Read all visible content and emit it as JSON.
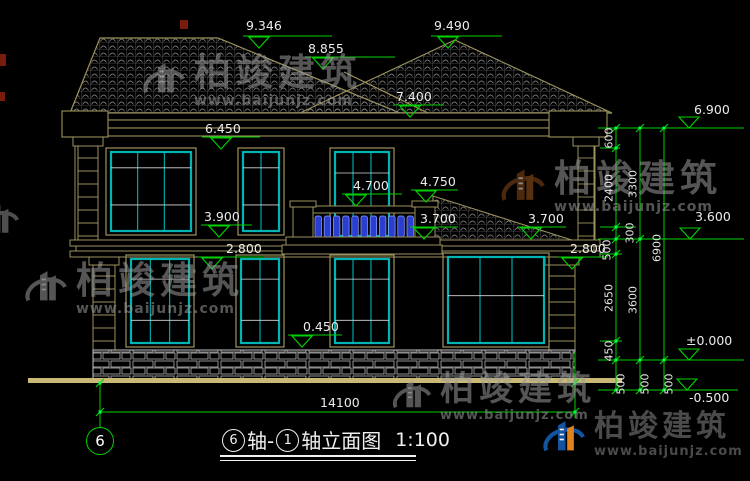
{
  "watermark": {
    "brand": "柏竣建筑",
    "url": "www.baijunjz.com"
  },
  "markers": {
    "ridge_left": "9.346",
    "valley": "8.855",
    "ridge_right": "9.490",
    "roof_low": "7.400",
    "f2_window_top": "6.450",
    "f2_band": "3.900",
    "balcony_rail": "4.700",
    "porch_top": "4.750",
    "balcony_floor": "3.700",
    "porch_eave": "3.700",
    "f1_band_right": "2.800",
    "f1_window_top": "2.800",
    "f1_sill": "0.450",
    "eave_right": "6.900",
    "f2_floor_right": "3.600",
    "ground": "±0.000",
    "site": "-0.500"
  },
  "dims": {
    "chain_inner": [
      "600",
      "2400",
      "300",
      "500",
      "2650",
      "450",
      "500"
    ],
    "chain_mid": [
      "3300",
      "3600",
      "500"
    ],
    "chain_outer": [
      "6900",
      "500"
    ],
    "total_width": "14100"
  },
  "footer": {
    "axis_bubble": "6",
    "axis_start": "6",
    "seg1": "轴-",
    "axis_end": "1",
    "seg2": "轴立面图",
    "scale": "1:100"
  }
}
